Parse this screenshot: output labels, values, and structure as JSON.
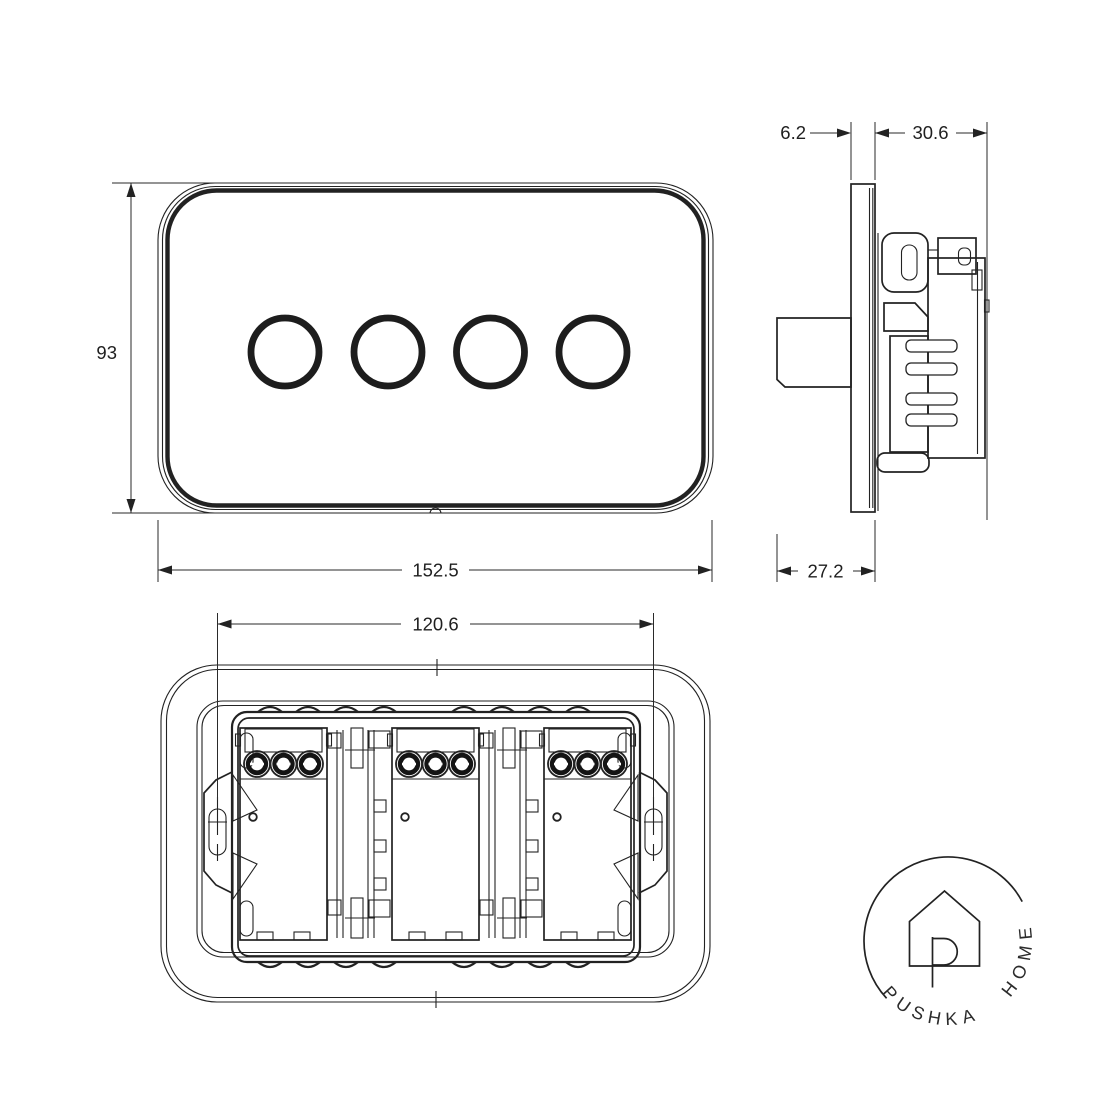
{
  "views": {
    "front": {
      "height_mm": "93",
      "width_mm": "152.5"
    },
    "side": {
      "plate_thickness_mm": "6.2",
      "mechanism_depth_mm": "30.6",
      "knob_projection_mm": "27.2"
    },
    "back": {
      "fixing_centres_mm": "120.6"
    }
  },
  "logo": {
    "text": "PUSHKA HOME"
  },
  "colors": {
    "line": "#222222",
    "background": "#ffffff"
  }
}
